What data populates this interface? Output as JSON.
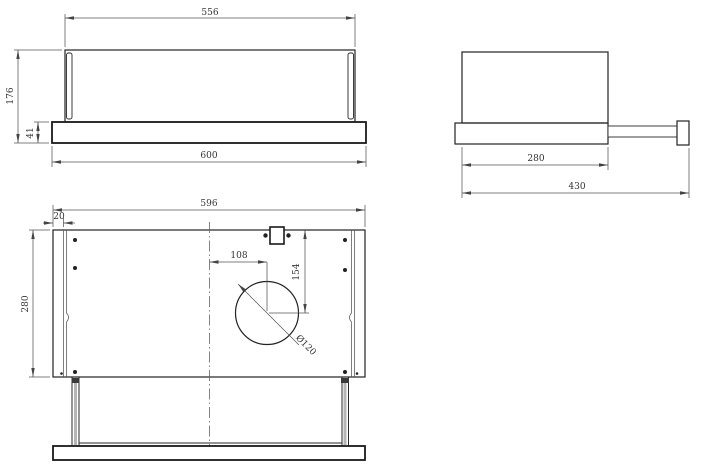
{
  "drawing": {
    "front_view": {
      "width_top": "556",
      "height_total": "176",
      "base_height": "41",
      "width_base": "600"
    },
    "side_view": {
      "depth_body": "280",
      "depth_total": "430"
    },
    "bottom_view": {
      "width": "596",
      "side_inset": "20",
      "depth": "280",
      "hole_offset_x": "108",
      "hole_offset_y": "154",
      "hole_diameter": "Ø120"
    }
  }
}
